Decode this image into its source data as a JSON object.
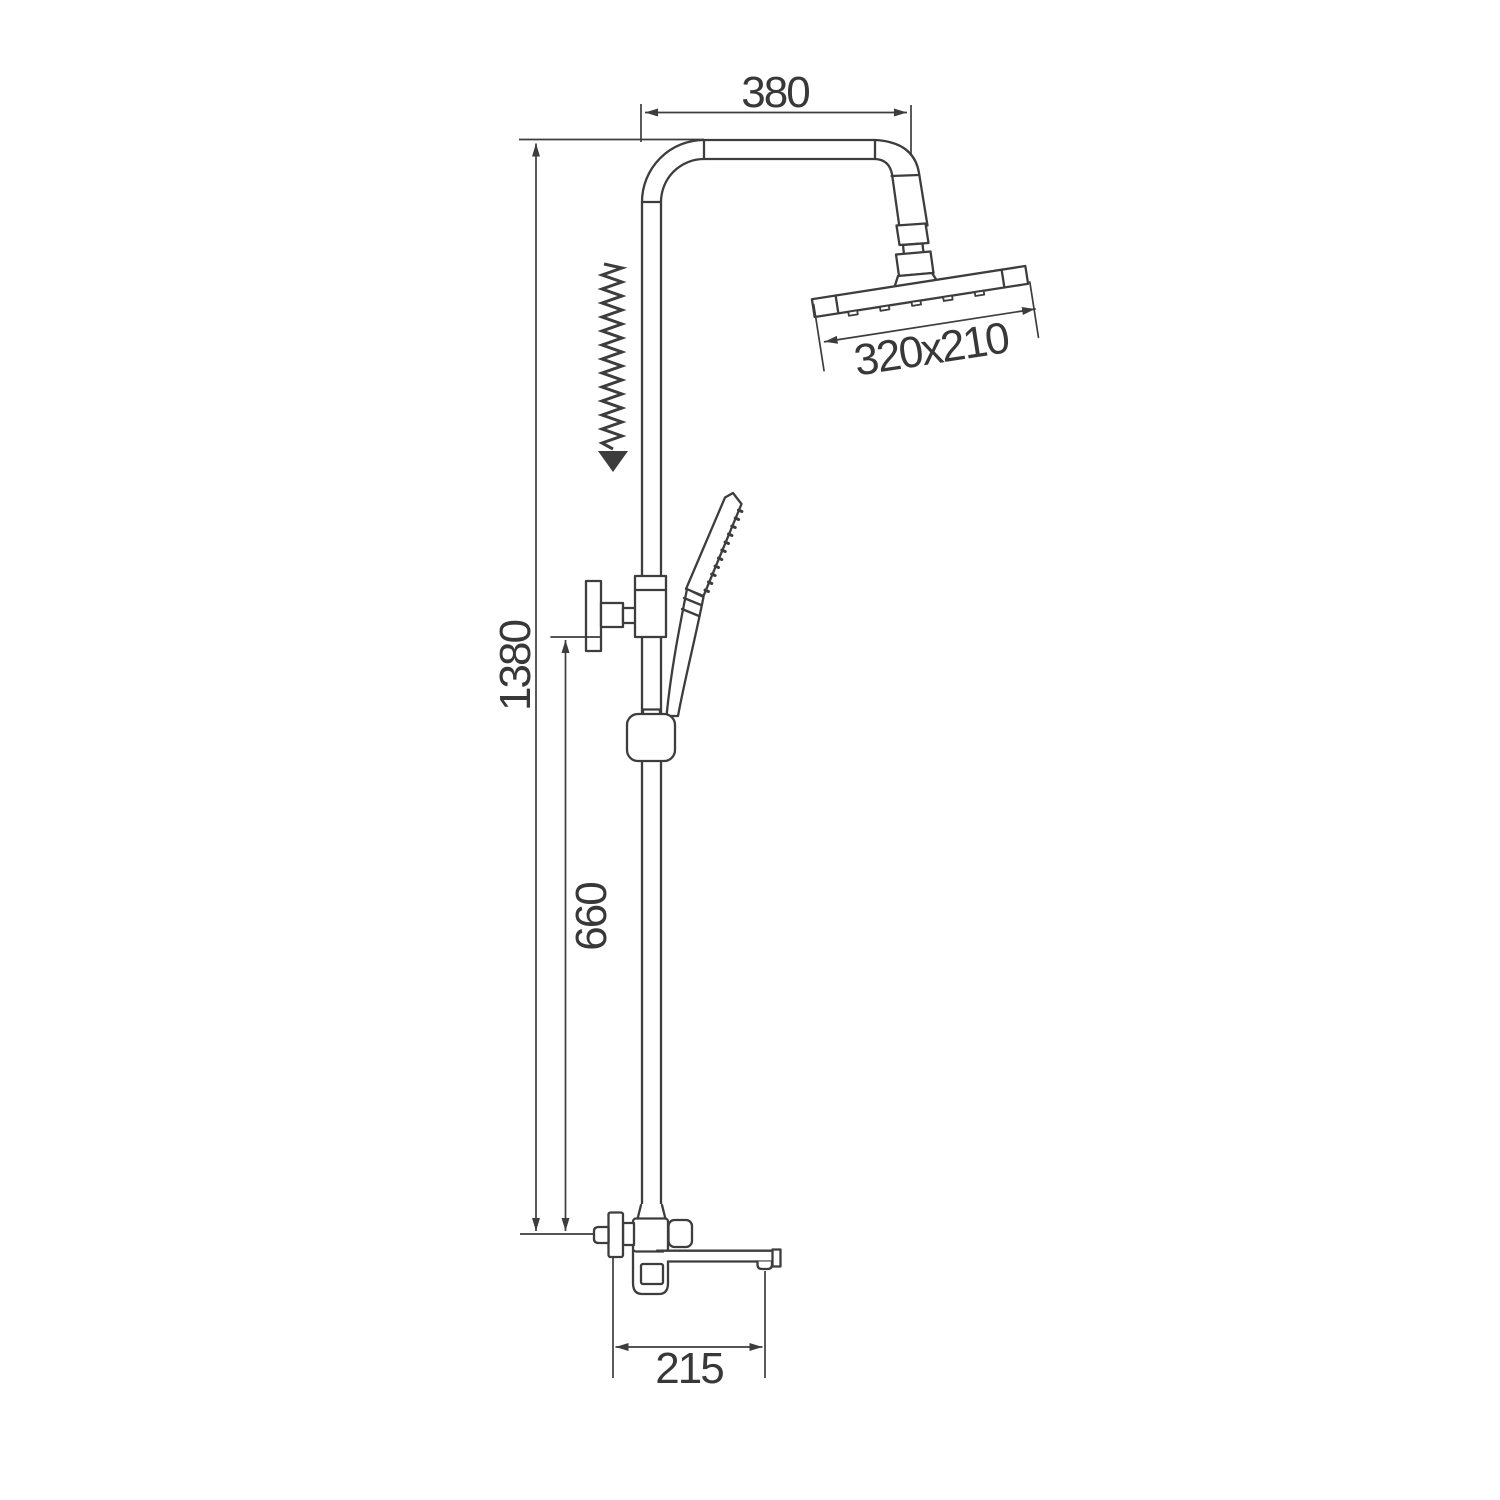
{
  "page": {
    "type": "technical dimension drawing",
    "subject": "shower column with overhead rain shower, hand shower on sliding rail, and bath spout mixer",
    "background": "#ffffff"
  },
  "colors": {
    "line": "#3d3d3d",
    "text": "#383838"
  },
  "labels": {
    "top_arm_width": "380",
    "head_size": "320x210",
    "total_height": "1380",
    "lower_height": "660",
    "spout_reach": "215"
  }
}
